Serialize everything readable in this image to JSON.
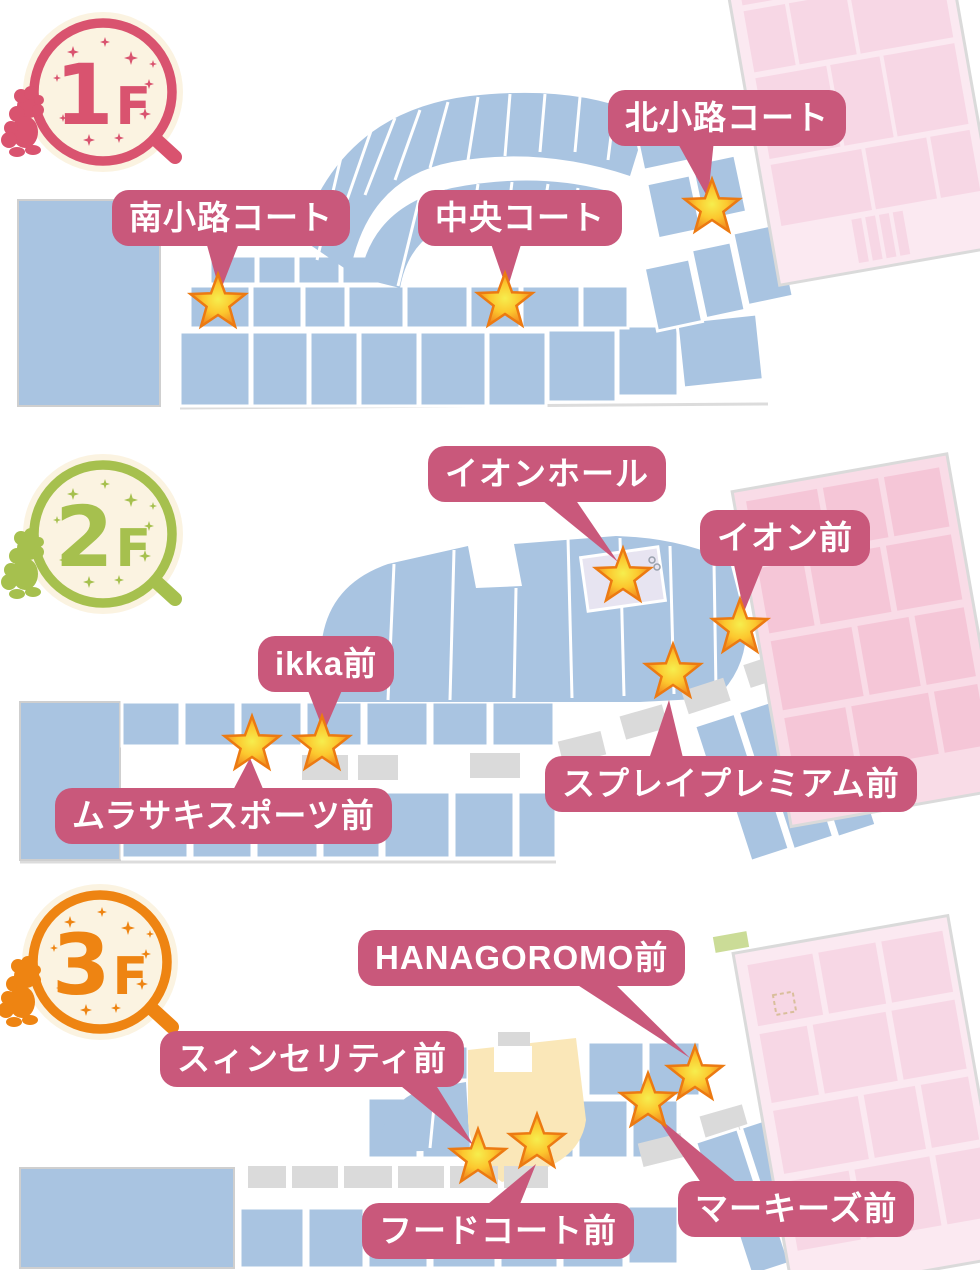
{
  "floors": [
    {
      "name": "1F",
      "badge": {
        "number": "1",
        "suffix": "F"
      },
      "accent_color": "#D9536F",
      "markers": [
        {
          "label": "南小路コート"
        },
        {
          "label": "中央コート"
        },
        {
          "label": "北小路コート"
        }
      ]
    },
    {
      "name": "2F",
      "badge": {
        "number": "2",
        "suffix": "F"
      },
      "accent_color": "#A6C04E",
      "markers": [
        {
          "label": "イオンホール"
        },
        {
          "label": "イオン前"
        },
        {
          "label": "ikka前"
        },
        {
          "label": "ムラサキスポーツ前"
        },
        {
          "label": "スプレイプレミアム前"
        }
      ]
    },
    {
      "name": "3F",
      "badge": {
        "number": "3",
        "suffix": "F"
      },
      "accent_color": "#EE8412",
      "markers": [
        {
          "label": "HANAGOROMO前"
        },
        {
          "label": "スィンセリティ前"
        },
        {
          "label": "フードコート前"
        },
        {
          "label": "マーキーズ前"
        }
      ]
    }
  ],
  "colors": {
    "label_background": "#C9587B",
    "label_text": "#FFFFFF",
    "store_block_blue": "#A9C4E1",
    "department_store_pink": "#F5C6D7",
    "department_store_pink_light": "#F7D7E5",
    "corridor_kiosk_gray": "#DADADA",
    "food_court_yellow": "#FAE7B8",
    "event_hall_lavender": "#E7E4F1",
    "star_orange": "#F0821E",
    "star_yellow": "#F6EE4E",
    "badge_cream": "#FBF3E1",
    "floor1_accent": "#D9536F",
    "floor2_accent": "#A6C04E",
    "floor3_accent": "#EE8412"
  }
}
